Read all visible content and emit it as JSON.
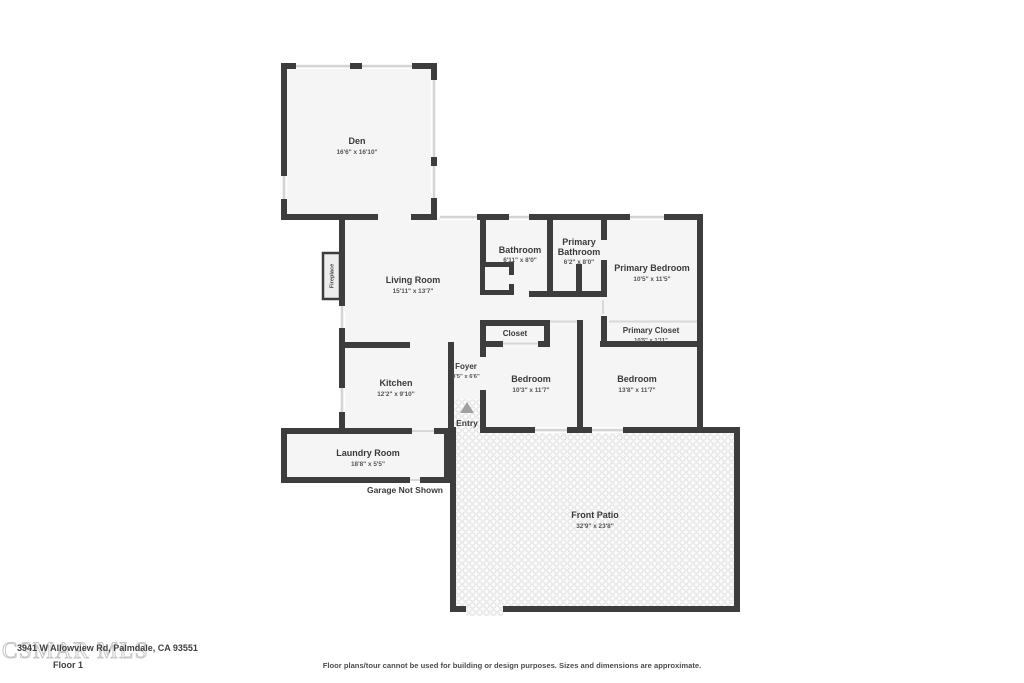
{
  "colors": {
    "wall": "#3d3d3d",
    "room_fill": "#f5f5f5",
    "window_bar": "#d4d4d4",
    "door_line": "#d8d8d8",
    "patio_dot": "#e4e4e4",
    "entry_arrow": "#a0a0a0"
  },
  "rooms": {
    "den": {
      "name": "Den",
      "dims": "16'6\" x 16'10\""
    },
    "living_room": {
      "name": "Living Room",
      "dims": "15'11\" x 13'7\""
    },
    "bathroom": {
      "name": "Bathroom",
      "dims": "6'11\" x 8'0\""
    },
    "primary_bathroom": {
      "name_line1": "Primary",
      "name_line2": "Bathroom",
      "dims": "6'2\" x 8'0\""
    },
    "primary_bedroom": {
      "name": "Primary Bedroom",
      "dims": "10'5\" x 11'5\""
    },
    "closet": {
      "name": "Closet"
    },
    "primary_closet": {
      "name": "Primary Closet",
      "dims": "10'5\" x 1'11\""
    },
    "foyer": {
      "name": "Foyer",
      "dims": "3'5\" x 6'6\""
    },
    "bedroom_left": {
      "name": "Bedroom",
      "dims": "10'3\" x 11'7\""
    },
    "bedroom_right": {
      "name": "Bedroom",
      "dims": "13'8\" x 11'7\""
    },
    "kitchen": {
      "name": "Kitchen",
      "dims": "12'2\" x 9'10\""
    },
    "laundry_room": {
      "name": "Laundry Room",
      "dims": "18'8\" x 5'5\""
    },
    "front_patio": {
      "name": "Front Patio",
      "dims": "32'9\" x 23'8\""
    }
  },
  "annotations": {
    "fireplace": "Fireplace",
    "entry": "Entry",
    "garage_note": "Garage Not Shown"
  },
  "footer": {
    "address": "3941 W Allowview Rd, Palmdale, CA 93551",
    "floor_label": "Floor 1",
    "watermark": "CSMAR MLS",
    "disclaimer": "Floor plans/tour cannot be used for building or design purposes. Sizes and dimensions are approximate."
  }
}
